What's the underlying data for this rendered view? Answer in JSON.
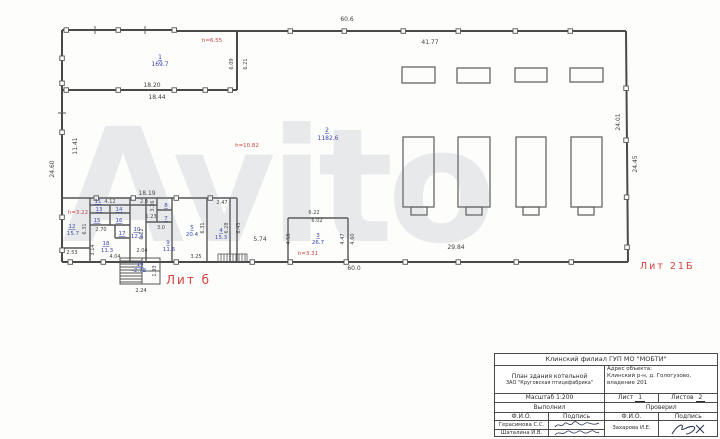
{
  "watermark": "Avito",
  "plan": {
    "lit_left": "Лит б",
    "lit_right": "Лит 21Б",
    "rooms": [
      {
        "n": "1",
        "a": "169.7"
      },
      {
        "n": "2",
        "a": "1182.6"
      },
      {
        "n": "3",
        "a": "26.7"
      },
      {
        "n": "4",
        "a": "15.3"
      },
      {
        "n": "5",
        "a": "20.4"
      },
      {
        "n": "7",
        "a": ""
      },
      {
        "n": "8",
        "a": ""
      },
      {
        "n": "9",
        "a": "11.6"
      },
      {
        "n": "10",
        "a": "12.4"
      },
      {
        "n": "11",
        "a": ""
      },
      {
        "n": "12",
        "a": "15.7"
      },
      {
        "n": "13",
        "a": ""
      },
      {
        "n": "14",
        "a": ""
      },
      {
        "n": "15",
        "a": ""
      },
      {
        "n": "16",
        "a": ""
      },
      {
        "n": "17",
        "a": ""
      },
      {
        "n": "18",
        "a": "11.3"
      },
      {
        "n": "19",
        "a": "-2.78"
      }
    ],
    "heights": [
      {
        "t": "h=6.55"
      },
      {
        "t": "h=10.82"
      },
      {
        "t": "h=3.22"
      },
      {
        "t": "h=3.31"
      }
    ],
    "dims": [
      {
        "t": "60.6"
      },
      {
        "t": "41.77"
      },
      {
        "t": "24.01"
      },
      {
        "t": "24.45"
      },
      {
        "t": "11.41"
      },
      {
        "t": "24.60"
      },
      {
        "t": "18.20"
      },
      {
        "t": "18.44"
      },
      {
        "t": "6.09"
      },
      {
        "t": "6.21"
      },
      {
        "t": "18.19"
      },
      {
        "t": "4.12"
      },
      {
        "t": "2.0"
      },
      {
        "t": "2.70"
      },
      {
        "t": "6.31"
      },
      {
        "t": "3.14"
      },
      {
        "t": "2.53"
      },
      {
        "t": "4.04"
      },
      {
        "t": "2.04"
      },
      {
        "t": "6.12"
      },
      {
        "t": "3.26"
      },
      {
        "t": "1.23"
      },
      {
        "t": "3.0"
      },
      {
        "t": "3.25"
      },
      {
        "t": "6.31"
      },
      {
        "t": "6.28"
      },
      {
        "t": "6.45"
      },
      {
        "t": "2.47"
      },
      {
        "t": "5.74"
      },
      {
        "t": "4.58"
      },
      {
        "t": "6.22"
      },
      {
        "t": "6.02"
      },
      {
        "t": "4.47"
      },
      {
        "t": "4.60"
      },
      {
        "t": "60.0"
      },
      {
        "t": "29.84"
      },
      {
        "t": "2.24"
      },
      {
        "t": "1.93"
      }
    ]
  },
  "titleblock": {
    "org": "Клинский филиал ГУП МО \"МОБТИ\"",
    "doc_line1": "План здания котельной",
    "doc_line2": "ЗАО \"Круговская птицефабрика\"",
    "address_label": "Адрес объекта:",
    "address_line1": "Клинский р-н, д. Гологузово,",
    "address_line2": "владение 201",
    "scale": "Масштаб 1:200",
    "sheet_label": "Лист",
    "sheet_value": "1",
    "sheets_label": "Листов",
    "sheets_value": "2",
    "performed_label": "Выполнил",
    "checked_label": "Проверил",
    "fio_label": "Ф.И.О.",
    "signature_label": "Подпись",
    "executor1": "Герасимова С.С.",
    "executor2": "Шаталина И.В.",
    "checker": "Захарова И.Е."
  }
}
